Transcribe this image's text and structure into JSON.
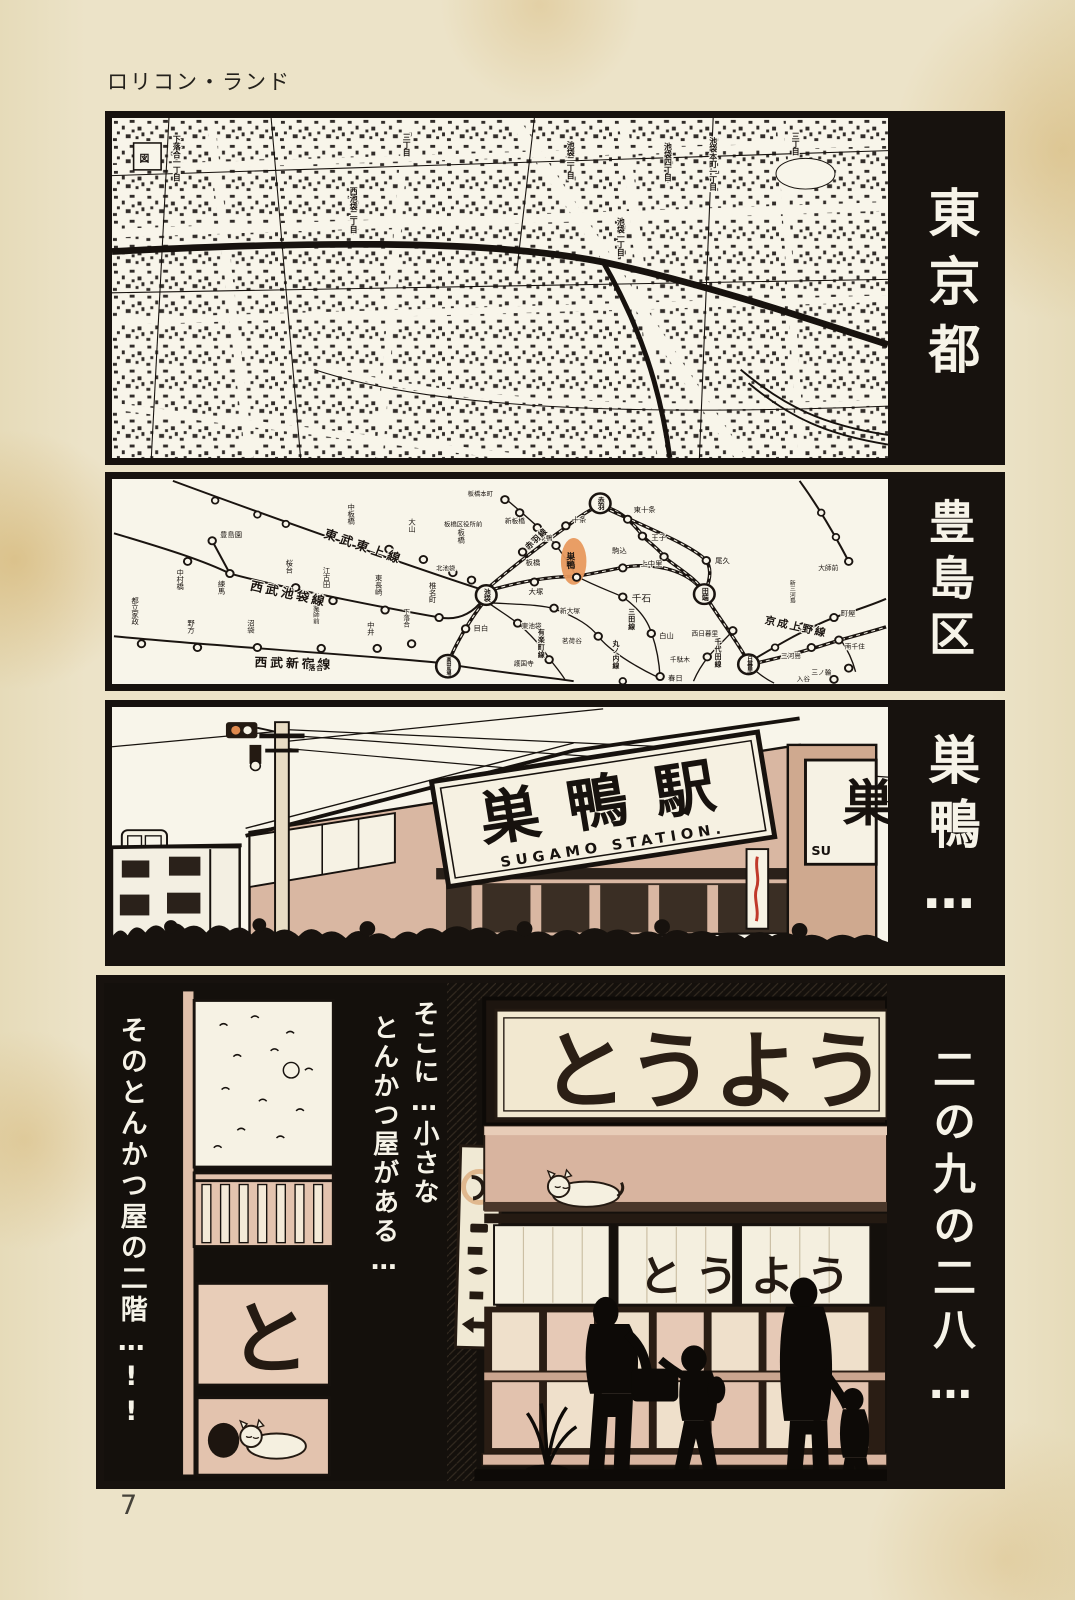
{
  "page": {
    "title": "ロリコン・ランド",
    "page_number": "7"
  },
  "side_captions": [
    {
      "text": "東京都"
    },
    {
      "text": "豊島区"
    },
    {
      "text": "巣鴨…"
    },
    {
      "text": "二の九の二八…"
    }
  ],
  "panel1_map": {
    "labels": [
      {
        "text": "下落合一丁目",
        "x": 66,
        "y": 18,
        "vertical": true
      },
      {
        "text": "図",
        "x": 28,
        "y": 46,
        "vertical": false,
        "size": 10
      },
      {
        "text": "三丁目",
        "x": 300,
        "y": 16,
        "vertical": true
      },
      {
        "text": "西池袋二丁目",
        "x": 246,
        "y": 72,
        "vertical": true
      },
      {
        "text": "池袋二丁目",
        "x": 467,
        "y": 24,
        "vertical": true
      },
      {
        "text": "池袋一丁目",
        "x": 518,
        "y": 104,
        "vertical": true
      },
      {
        "text": "池袋四丁目",
        "x": 566,
        "y": 26,
        "vertical": true
      },
      {
        "text": "池袋本町一丁目",
        "x": 612,
        "y": 20,
        "vertical": true
      },
      {
        "text": "三丁目",
        "x": 696,
        "y": 15,
        "vertical": true
      }
    ]
  },
  "panel2_rail": {
    "highlight_color": "#e8995e",
    "line_labels": [
      {
        "text": "東武東上線",
        "x": 215,
        "y": 62,
        "angle": 20,
        "size": 13,
        "ls": 4
      },
      {
        "text": "西武池袋線",
        "x": 140,
        "y": 118,
        "angle": 13,
        "size": 13,
        "ls": 3
      },
      {
        "text": "西武新宿線",
        "x": 145,
        "y": 200,
        "angle": 2,
        "size": 13,
        "ls": 3
      },
      {
        "text": "赤羽線",
        "x": 424,
        "y": 76,
        "angle": -45,
        "size": 8.5
      },
      {
        "text": "京成上野線",
        "x": 664,
        "y": 154,
        "angle": 13,
        "size": 11,
        "ls": 2
      },
      {
        "text": "三田線",
        "x": 528,
        "y": 138,
        "vertical": true,
        "size": 7
      },
      {
        "text": "丸ノ内線",
        "x": 512,
        "y": 172,
        "vertical": true,
        "size": 7
      },
      {
        "text": "有楽町線",
        "x": 436,
        "y": 160,
        "vertical": true,
        "size": 7
      },
      {
        "text": "千代田線",
        "x": 616,
        "y": 170,
        "vertical": true,
        "size": 7
      },
      {
        "text": "落合",
        "x": 200,
        "y": 204,
        "size": 7
      }
    ],
    "major_stations": [
      {
        "n": "池袋",
        "x": 381,
        "y": 124
      },
      {
        "n": "赤羽",
        "x": 497,
        "y": 26
      },
      {
        "n": "高田馬場",
        "x": 342,
        "y": 200
      },
      {
        "n": "田端",
        "x": 603,
        "y": 123
      },
      {
        "n": "日暮里",
        "x": 648,
        "y": 198
      }
    ],
    "stations": [
      {
        "n": "豊島園",
        "x": 102,
        "y": 66,
        "lx": 110,
        "ly": 62
      },
      {
        "n": "中村橋",
        "x": 77,
        "y": 88,
        "lx": 70,
        "ly": 96,
        "v": true
      },
      {
        "n": "練馬",
        "x": 120,
        "y": 101,
        "lx": 112,
        "ly": 108,
        "v": true
      },
      {
        "n": "桜台",
        "x": 187,
        "y": 116,
        "lx": 181,
        "ly": 86,
        "v": true
      },
      {
        "n": "江古田",
        "x": 225,
        "y": 130,
        "lx": 219,
        "ly": 94,
        "v": true
      },
      {
        "n": "東長崎",
        "x": 278,
        "y": 140,
        "lx": 272,
        "ly": 102,
        "v": true
      },
      {
        "n": "椎名町",
        "x": 333,
        "y": 148,
        "lx": 327,
        "ly": 110,
        "v": true
      },
      {
        "n": "都立家政",
        "x": 30,
        "y": 176,
        "lx": 24,
        "ly": 126,
        "v": true
      },
      {
        "n": "野方",
        "x": 87,
        "y": 180,
        "lx": 81,
        "ly": 150,
        "v": true
      },
      {
        "n": "沼袋",
        "x": 148,
        "y": 180,
        "lx": 142,
        "ly": 150,
        "v": true
      },
      {
        "n": "新井薬師前",
        "x": 213,
        "y": 181,
        "lx": 207,
        "ly": 122,
        "v": true,
        "s": 6.6
      },
      {
        "n": "中井",
        "x": 270,
        "y": 181,
        "lx": 264,
        "ly": 152,
        "v": true
      },
      {
        "n": "下落合",
        "x": 305,
        "y": 176,
        "lx": 299,
        "ly": 138,
        "v": true,
        "s": 6.8
      },
      {
        "n": "目白",
        "x": 360,
        "y": 160,
        "lx": 368,
        "ly": 162
      },
      {
        "n": "中板橋",
        "x": 282,
        "y": 75,
        "lx": 244,
        "ly": 26,
        "v": true
      },
      {
        "n": "大山",
        "x": 317,
        "y": 86,
        "lx": 306,
        "ly": 42,
        "v": true
      },
      {
        "n": "下板橋",
        "x": 347,
        "y": 100,
        "lx": 356,
        "ly": 46,
        "v": true
      },
      {
        "n": "北池袋",
        "x": 366,
        "y": 108,
        "lx": 330,
        "ly": 98,
        "s": 6.5
      },
      {
        "n": "板橋",
        "x": 418,
        "y": 78,
        "lx": 421,
        "ly": 92
      },
      {
        "n": "十条",
        "x": 462,
        "y": 50,
        "lx": 468,
        "ly": 46
      },
      {
        "n": "東十条",
        "x": 525,
        "y": 43,
        "lx": 531,
        "ly": 35
      },
      {
        "n": "王子",
        "x": 540,
        "y": 61,
        "lx": 549,
        "ly": 65
      },
      {
        "n": "上中里",
        "x": 562,
        "y": 83,
        "lx": 538,
        "ly": 93
      },
      {
        "n": "尾久",
        "x": 605,
        "y": 87,
        "lx": 614,
        "ly": 90
      },
      {
        "n": "西巣鴨",
        "x": 452,
        "y": 71,
        "lx": 428,
        "ly": 65,
        "s": 6.8
      },
      {
        "n": "新板橋",
        "x": 433,
        "y": 52,
        "lx": 400,
        "ly": 47,
        "s": 6.8
      },
      {
        "n": "板橋区役所前",
        "x": 415,
        "y": 36,
        "lx": 338,
        "ly": 51,
        "s": 6.5
      },
      {
        "n": "板橋本町",
        "x": 400,
        "y": 22,
        "lx": 362,
        "ly": 18,
        "s": 6.5
      },
      {
        "n": "巣鴨",
        "x": 473,
        "y": 105,
        "lx": 466,
        "ly": 78,
        "v": true,
        "s": 9,
        "h": true
      },
      {
        "n": "駒込",
        "x": 520,
        "y": 95,
        "lx": 509,
        "ly": 79
      },
      {
        "n": "大塚",
        "x": 430,
        "y": 110,
        "lx": 424,
        "ly": 123
      },
      {
        "n": "新大塚",
        "x": 450,
        "y": 138,
        "lx": 456,
        "ly": 143,
        "s": 6.8
      },
      {
        "n": "東池袋",
        "x": 413,
        "y": 154,
        "lx": 417,
        "ly": 159,
        "s": 6.8
      },
      {
        "n": "千石",
        "x": 520,
        "y": 126,
        "lx": 529,
        "ly": 131,
        "s": 10
      },
      {
        "n": "白山",
        "x": 549,
        "y": 165,
        "lx": 557,
        "ly": 170
      },
      {
        "n": "茗荷谷",
        "x": 495,
        "y": 168,
        "lx": 458,
        "ly": 175,
        "s": 6.8
      },
      {
        "n": "護国寺",
        "x": 445,
        "y": 193,
        "lx": 409,
        "ly": 199,
        "s": 6.8
      },
      {
        "n": "春日",
        "x": 558,
        "y": 211,
        "lx": 566,
        "ly": 215
      },
      {
        "n": "千駄木",
        "x": 606,
        "y": 190,
        "lx": 568,
        "ly": 195,
        "s": 6.8
      },
      {
        "n": "西日暮里",
        "x": 632,
        "y": 162,
        "lx": 590,
        "ly": 167,
        "s": 6.8
      },
      {
        "n": "新三河島",
        "x": 703,
        "y": 158,
        "lx": 692,
        "ly": 108,
        "v": true,
        "s": 6.2
      },
      {
        "n": "町屋",
        "x": 735,
        "y": 148,
        "lx": 742,
        "ly": 146
      },
      {
        "n": "三河島",
        "x": 712,
        "y": 180,
        "lx": 681,
        "ly": 191,
        "s": 6.8
      },
      {
        "n": "南千住",
        "x": 740,
        "y": 172,
        "lx": 746,
        "ly": 181,
        "s": 6.8
      },
      {
        "n": "三ノ輪",
        "x": 750,
        "y": 202,
        "lx": 712,
        "ly": 209,
        "s": 6.8
      },
      {
        "n": "入谷",
        "x": 735,
        "y": 214,
        "lx": 697,
        "ly": 216,
        "s": 6.8
      },
      {
        "n": "大師前",
        "x": 750,
        "y": 88,
        "lx": 719,
        "ly": 97,
        "s": 6.8
      }
    ],
    "extra_dots": [
      [
        105,
        23
      ],
      [
        148,
        38
      ],
      [
        177,
        48
      ],
      [
        722,
        36
      ],
      [
        737,
        62
      ],
      [
        675,
        180
      ],
      [
        520,
        216
      ]
    ]
  },
  "panel3_station": {
    "sign_main": "巣鴨駅",
    "sign_sub": "SUGAMO STATION.",
    "sign_partial": "巣",
    "sign_partial_sub": "SU"
  },
  "panel4_shop": {
    "caption_left": "そのとんかつ屋の二階…!!",
    "caption_inner_col1": "そこに…小さな",
    "caption_inner_col2": "とんかつ屋がある…",
    "shop_sign": "とうよう",
    "noren_text": "とうよう",
    "small_sign_char": "と"
  }
}
